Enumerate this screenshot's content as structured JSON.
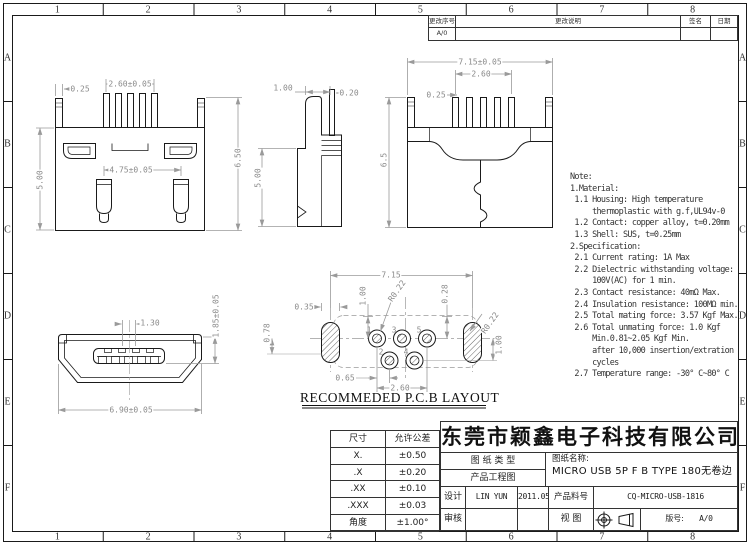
{
  "grid": {
    "cols": [
      "1",
      "2",
      "3",
      "4",
      "5",
      "6",
      "7",
      "8"
    ],
    "rows": [
      "A",
      "B",
      "C",
      "D",
      "E",
      "F"
    ]
  },
  "revision_table": {
    "headers": [
      "更改序号",
      "更改说明",
      "签名",
      "日期"
    ],
    "first_row_rev": "A/0"
  },
  "notes": {
    "lines": [
      "Note:",
      "1.Material:",
      " 1.1 Housing: High temperature",
      "     thermoplastic with g.f,UL94v-0",
      " 1.2 Contact: copper alloy, t=0.20mm",
      " 1.3 Shell: SUS, t=0.25mm",
      "2.Specification:",
      " 2.1 Current rating: 1A Max",
      " 2.2 Dielectric withstanding voltage:",
      "     100V(AC) for 1 min.",
      " 2.3 Contact resistance: 40mΩ Max.",
      " 2.4 Insulation resistance: 100MΩ min.",
      " 2.5 Total mating force: 3.57 Kgf Max.",
      " 2.6 Total unmating force: 1.0 Kgf",
      "     Min.0.81~2.05 Kgf Min.",
      "     after 10,000 insertion/extration",
      "     cycles",
      " 2.7 Temperature range: -30° C~80° C"
    ]
  },
  "dim_labels": [
    {
      "view": "top-view",
      "t": "0.25",
      "x": 80,
      "y": 89,
      "r": 0
    },
    {
      "view": "top-view",
      "t": "2.60±0.05",
      "x": 130,
      "y": 84,
      "r": 0
    },
    {
      "view": "top-view",
      "t": "4.75±0.05",
      "x": 131,
      "y": 170,
      "r": 0
    },
    {
      "view": "top-view",
      "t": "5.00",
      "x": 40,
      "y": 180,
      "r": -90
    },
    {
      "view": "top-view",
      "t": "6.50",
      "x": 238,
      "y": 158,
      "r": -90
    },
    {
      "view": "side-view",
      "t": "1.00",
      "x": 283,
      "y": 88,
      "r": 0
    },
    {
      "view": "side-view",
      "t": "0.20",
      "x": 349,
      "y": 93,
      "r": 0
    },
    {
      "view": "side-view",
      "t": "5.00",
      "x": 258,
      "y": 178,
      "r": -90
    },
    {
      "view": "back-view",
      "t": "7.15±0.05",
      "x": 480,
      "y": 62,
      "r": 0
    },
    {
      "view": "back-view",
      "t": "2.60",
      "x": 481,
      "y": 74,
      "r": 0
    },
    {
      "view": "back-view",
      "t": "0.25",
      "x": 436,
      "y": 95,
      "r": 0
    },
    {
      "view": "back-view",
      "t": "6.5",
      "x": 384,
      "y": 160,
      "r": -90
    },
    {
      "view": "front-view",
      "t": "1.30",
      "x": 150,
      "y": 323,
      "r": 0
    },
    {
      "view": "front-view",
      "t": "1.85±0.05",
      "x": 216,
      "y": 316,
      "r": -90
    },
    {
      "view": "front-view",
      "t": "6.90±0.05",
      "x": 131,
      "y": 410,
      "r": 0
    },
    {
      "view": "pcb-layout",
      "t": "7.15",
      "x": 391,
      "y": 275,
      "r": 0
    },
    {
      "view": "pcb-layout",
      "t": "0.35",
      "x": 304,
      "y": 307,
      "r": 0
    },
    {
      "view": "pcb-layout",
      "t": "1.00",
      "x": 363,
      "y": 296,
      "r": -90
    },
    {
      "view": "pcb-layout",
      "t": "R0.22",
      "x": 397,
      "y": 291,
      "r": -55
    },
    {
      "view": "pcb-layout",
      "t": "0.28",
      "x": 445,
      "y": 294,
      "r": -90
    },
    {
      "view": "pcb-layout",
      "t": "R0.22",
      "x": 490,
      "y": 323,
      "r": -55
    },
    {
      "view": "pcb-layout",
      "t": "0.78",
      "x": 267,
      "y": 333,
      "r": -90
    },
    {
      "view": "pcb-layout",
      "t": "1.00",
      "x": 499,
      "y": 345,
      "r": -90
    },
    {
      "view": "pcb-layout",
      "t": "0.65",
      "x": 345,
      "y": 378,
      "r": 0
    },
    {
      "view": "pcb-layout",
      "t": "2.60",
      "x": 400,
      "y": 388,
      "r": 0
    }
  ],
  "pcb": {
    "caption": "RECOMMEDED P.C.B LAYOUT",
    "pad_numbers": [
      {
        "t": "1",
        "x": 369,
        "y": 330
      },
      {
        "t": "3",
        "x": 394,
        "y": 330
      },
      {
        "t": "5",
        "x": 419,
        "y": 330
      },
      {
        "t": "2",
        "x": 381,
        "y": 352
      },
      {
        "t": "4",
        "x": 406,
        "y": 352
      }
    ]
  },
  "tolerance_table": {
    "headers": [
      "尺寸",
      "允许公差"
    ],
    "rows": [
      [
        "X.",
        "±0.50"
      ],
      [
        ".X",
        "±0.20"
      ],
      [
        ".XX",
        "±0.10"
      ],
      [
        ".XXX",
        "±0.03"
      ],
      [
        "角度",
        "±1.00°"
      ]
    ]
  },
  "title_block": {
    "company": "东莞市颖鑫电子科技有限公司",
    "doc_type_label": "图 纸 类 型",
    "doc_type_value": "产品工程图",
    "drawing_name_label": "图纸名称:",
    "drawing_name_value": "MICRO USB 5P F B TYPE 180无卷边",
    "design_label": "设计",
    "designer": "LIN YUN",
    "date": "2011.05.22",
    "part_no_label": "产品料号",
    "part_no": "CQ-MICRO-USB-1816",
    "review_label": "审核",
    "view_label": "视  图",
    "version_label": "版号:",
    "version": "A/0"
  }
}
